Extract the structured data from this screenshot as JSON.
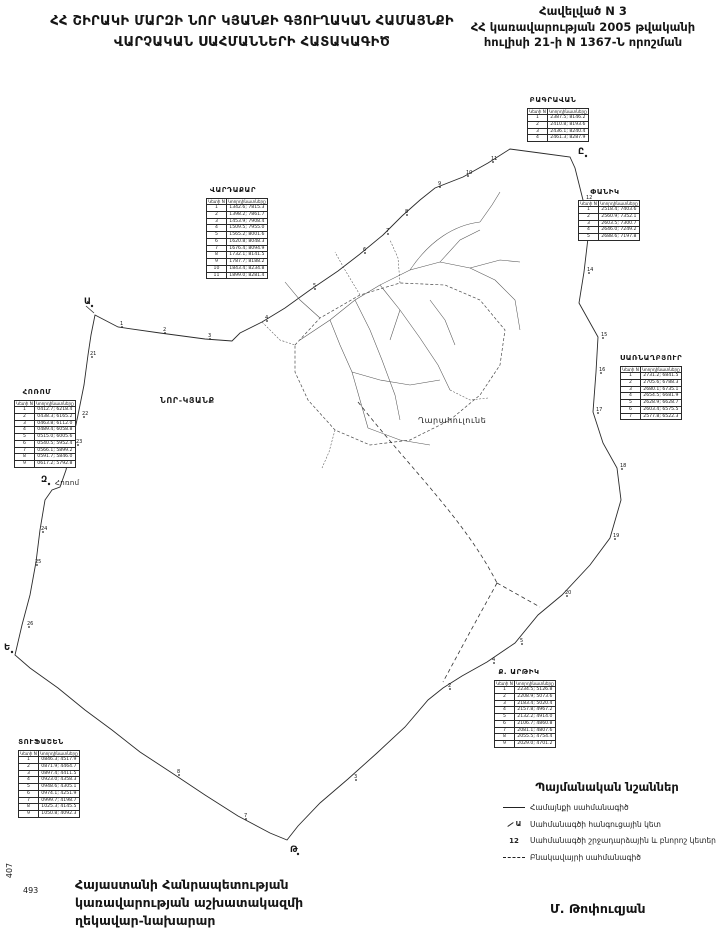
{
  "header": {
    "title_line1": "ՀՀ ՇԻՐԱԿԻ ՄԱՐԶԻ ՆՈՐ ԿՅԱՆՔԻ ԳՅՈՒՂԱԿԱՆ ՀԱՄԱՅՆՔԻ",
    "title_line2": "ՎԱՐՉԱԿԱՆ ՍԱՀՄԱՆՆԵՐԻ ՀԱՏԱԿԱԳԻԾ",
    "annex_line1": "Հավելված N 3",
    "annex_line2": "ՀՀ կառավարության 2005 թվականի",
    "annex_line3": "հուլիսի 21-ի N 1367-Ն որոշման"
  },
  "map": {
    "labels": [
      {
        "text": "ՆՈՐ-ԿՅԱՆՔ",
        "x": 160,
        "y": 396,
        "cls": "big"
      },
      {
        "text": "Ղարահուլունե",
        "x": 418,
        "y": 416,
        "cls": ""
      },
      {
        "text": "Հոռոմ",
        "x": 55,
        "y": 479,
        "cls": "small"
      }
    ],
    "letter_points": [
      {
        "t": "Ա",
        "x": 84,
        "y": 302
      },
      {
        "t": "Ը",
        "x": 578,
        "y": 152
      },
      {
        "t": "Ե",
        "x": 4,
        "y": 648
      },
      {
        "t": "Թ",
        "x": 290,
        "y": 850
      },
      {
        "t": "Զ",
        "x": 41,
        "y": 480
      }
    ],
    "number_points": [
      {
        "t": "1",
        "x": 120,
        "y": 323
      },
      {
        "t": "2",
        "x": 163,
        "y": 329
      },
      {
        "t": "3",
        "x": 208,
        "y": 335
      },
      {
        "t": "4",
        "x": 265,
        "y": 317
      },
      {
        "t": "5",
        "x": 313,
        "y": 285
      },
      {
        "t": "6",
        "x": 363,
        "y": 249
      },
      {
        "t": "7",
        "x": 386,
        "y": 230
      },
      {
        "t": "8",
        "x": 405,
        "y": 211
      },
      {
        "t": "9",
        "x": 438,
        "y": 183
      },
      {
        "t": "10",
        "x": 466,
        "y": 172
      },
      {
        "t": "11",
        "x": 491,
        "y": 158
      },
      {
        "t": "12",
        "x": 586,
        "y": 197
      },
      {
        "t": "13",
        "x": 591,
        "y": 235
      },
      {
        "t": "14",
        "x": 587,
        "y": 269
      },
      {
        "t": "15",
        "x": 601,
        "y": 334
      },
      {
        "t": "16",
        "x": 599,
        "y": 369
      },
      {
        "t": "17",
        "x": 596,
        "y": 409
      },
      {
        "t": "18",
        "x": 620,
        "y": 465
      },
      {
        "t": "19",
        "x": 613,
        "y": 535
      },
      {
        "t": "20",
        "x": 565,
        "y": 592
      },
      {
        "t": "21",
        "x": 90,
        "y": 353
      },
      {
        "t": "22",
        "x": 82,
        "y": 413
      },
      {
        "t": "23",
        "x": 76,
        "y": 441
      },
      {
        "t": "24",
        "x": 41,
        "y": 528
      },
      {
        "t": "25",
        "x": 35,
        "y": 561
      },
      {
        "t": "26",
        "x": 27,
        "y": 623
      },
      {
        "t": "2",
        "x": 448,
        "y": 685
      },
      {
        "t": "3",
        "x": 354,
        "y": 776
      },
      {
        "t": "4",
        "x": 492,
        "y": 659
      },
      {
        "t": "5",
        "x": 520,
        "y": 640
      },
      {
        "t": "7",
        "x": 244,
        "y": 815
      },
      {
        "t": "8",
        "x": 177,
        "y": 771
      }
    ]
  },
  "tables": [
    {
      "title": "ԲԱԳՐԱՎԱՆ",
      "x": 527,
      "y": 96,
      "w": 52,
      "header": [
        "Կետի N",
        "Կոորդինատները"
      ],
      "rows": [
        [
          "1",
          "2387.5; 8146.2"
        ],
        [
          "2",
          "2410.8; 8193.6"
        ],
        [
          "3",
          "2436.1; 8240.4"
        ],
        [
          "4",
          "2461.3; 8287.9"
        ]
      ]
    },
    {
      "title": "ՎԱՐԴԱՔԱՐ",
      "x": 206,
      "y": 186,
      "w": 54,
      "header": [
        "Կետի N",
        "Կոորդինատները"
      ],
      "rows": [
        [
          "1",
          "1342.6; 7815.3"
        ],
        [
          "2",
          "1398.2; 7861.7"
        ],
        [
          "3",
          "1453.9; 7908.4"
        ],
        [
          "4",
          "1509.5; 7955.0"
        ],
        [
          "5",
          "1565.2; 8001.6"
        ],
        [
          "6",
          "1620.8; 8048.3"
        ],
        [
          "7",
          "1676.4; 8094.9"
        ],
        [
          "8",
          "1732.1; 8141.5"
        ],
        [
          "9",
          "1787.7; 8188.2"
        ],
        [
          "10",
          "1843.4; 8234.8"
        ],
        [
          "11",
          "1899.0; 8281.4"
        ]
      ]
    },
    {
      "title": "ՓԱՆԻԿ",
      "x": 578,
      "y": 188,
      "w": 54,
      "header": [
        "Կետի N",
        "Կոորդինատները"
      ],
      "rows": [
        [
          "1",
          "2518.4; 7403.6"
        ],
        [
          "2",
          "2560.9; 7352.1"
        ],
        [
          "3",
          "2603.5; 7300.7"
        ],
        [
          "4",
          "2646.0; 7249.2"
        ],
        [
          "5",
          "2688.6; 7197.8"
        ]
      ]
    },
    {
      "title": "ՍԱՌՆԱՂԲՅՈՒՐ",
      "x": 620,
      "y": 354,
      "w": 48,
      "header": [
        "Կետի N",
        "Կոորդինատները"
      ],
      "rows": [
        [
          "1",
          "2731.2; 6841.5"
        ],
        [
          "2",
          "2705.6; 6788.3"
        ],
        [
          "3",
          "2680.1; 6735.1"
        ],
        [
          "4",
          "2654.5; 6681.9"
        ],
        [
          "5",
          "2628.9; 6628.7"
        ],
        [
          "6",
          "2603.4; 6575.5"
        ],
        [
          "7",
          "2577.8; 6522.3"
        ]
      ]
    },
    {
      "title": "ՀՈՌՈՄ",
      "x": 14,
      "y": 388,
      "w": 46,
      "header": [
        "Կետի N",
        "Կոորդինատները"
      ],
      "rows": [
        [
          "1",
          "0412.7; 6218.4"
        ],
        [
          "2",
          "0438.3; 6165.2"
        ],
        [
          "3",
          "0463.8; 6112.0"
        ],
        [
          "4",
          "0489.4; 6058.8"
        ],
        [
          "5",
          "0515.0; 6005.6"
        ],
        [
          "6",
          "0540.5; 5952.4"
        ],
        [
          "7",
          "0566.1; 5899.2"
        ],
        [
          "8",
          "0591.7; 5846.0"
        ],
        [
          "9",
          "0617.2; 5792.8"
        ]
      ]
    },
    {
      "title": "ՏՈՒՖԱՇԵՆ",
      "x": 18,
      "y": 738,
      "w": 46,
      "header": [
        "Կետի N",
        "Կոորդինատները"
      ],
      "rows": [
        [
          "1",
          "0846.3; 4517.9"
        ],
        [
          "2",
          "0871.9; 4464.7"
        ],
        [
          "3",
          "0897.4; 4411.5"
        ],
        [
          "4",
          "0923.0; 4358.3"
        ],
        [
          "5",
          "0948.6; 4305.1"
        ],
        [
          "6",
          "0974.1; 4251.9"
        ],
        [
          "7",
          "0999.7; 4198.7"
        ],
        [
          "8",
          "1025.3; 4145.5"
        ],
        [
          "9",
          "1050.8; 4092.3"
        ]
      ]
    },
    {
      "title": "Ք. ԱՐԹԻԿ",
      "x": 494,
      "y": 668,
      "w": 50,
      "header": [
        "Կետի N",
        "Կոորդինատները"
      ],
      "rows": [
        [
          "1",
          "2234.5; 5126.8"
        ],
        [
          "2",
          "2208.9; 5073.6"
        ],
        [
          "3",
          "2183.4; 5020.4"
        ],
        [
          "4",
          "2157.8; 4967.2"
        ],
        [
          "5",
          "2132.2; 4914.0"
        ],
        [
          "6",
          "2106.7; 4860.8"
        ],
        [
          "7",
          "2081.1; 4807.6"
        ],
        [
          "8",
          "2055.5; 4754.4"
        ],
        [
          "9",
          "2029.0; 4701.2"
        ]
      ]
    }
  ],
  "legend": {
    "title": "Պայմանական նշաններ",
    "items": [
      {
        "symbol": "line",
        "label": "Համայնքի սահմանագիծ"
      },
      {
        "symbol": "Ա",
        "label": "Սահմանագծի հանգուցային կետ"
      },
      {
        "symbol": "12",
        "label": "Սահմանագծի շրջադարձային և բնորոշ կետեր"
      },
      {
        "symbol": "dashed",
        "label": "Բնակավայրի սահմանագիծ"
      }
    ]
  },
  "footer": {
    "line1": "Հայաստանի Հանրապետության",
    "line2": "կառավարության աշխատակազմի",
    "line3": "ղեկավար-նախարար",
    "signature": "Մ. Թոփուզյան",
    "corner_vertical": "407",
    "corner_number": "493"
  }
}
